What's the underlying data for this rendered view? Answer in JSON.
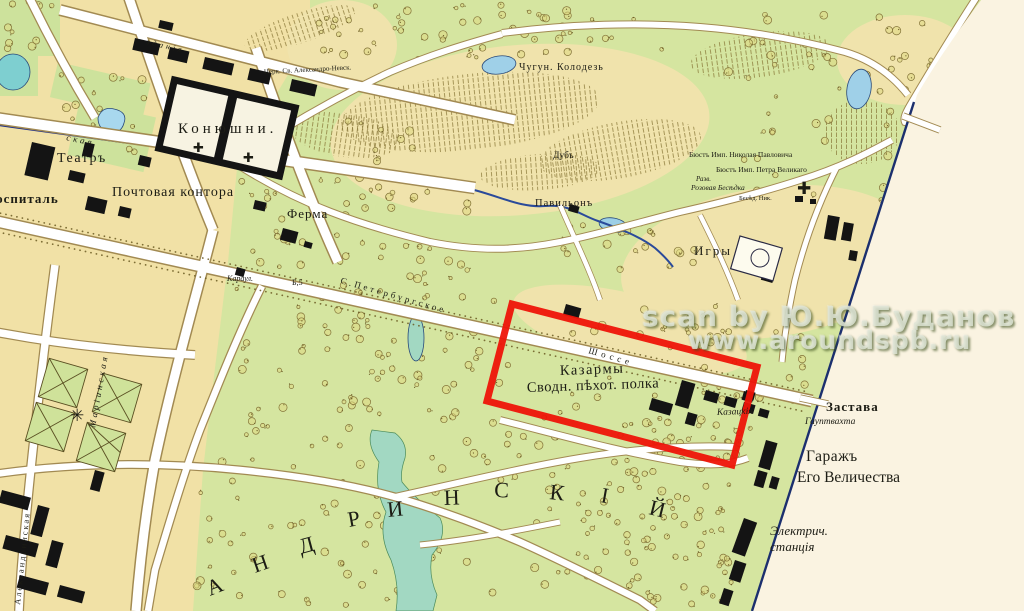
{
  "watermark": {
    "line1": "scan by Ю.Ю.Буданов",
    "line2": "www.aroundspb.ru"
  },
  "labels": {
    "hospital": "Госпиталь",
    "theater": "Театръ",
    "stables": "Конюшни.",
    "post_office": "Почтовая контора",
    "church_alexander": "Церк. Св. Александро-Невск.",
    "farm": "Ферма",
    "iron_well": "Чугун. Колодезь",
    "oak": "Дубъ",
    "pavilion": "Павильонъ",
    "games": "Игры",
    "bust_nicholas": "Бюстъ Имп. Николая Павловича",
    "bust_peter": "Бюстъ Имп. Петра Великаго",
    "ruins": "Разв.",
    "rose_arbor": "Розовая Бесѣдка",
    "arbor_nik": "Бесѣд. Ник.",
    "barracks_line1": "Казармы",
    "barracks_line2": "Сводн. пѣхот. полка",
    "cossack": "Казацкія",
    "outpost": "Застава",
    "guardhouse": "Гауптвахта",
    "garage_line1": "Гаражъ",
    "garage_line2": "Его Величества",
    "power_line1": "Электрич.",
    "power_line2": "станція",
    "road_petersburg": "С.Петербургское",
    "road_shosse": "Шоссе",
    "karaul": "Караул.",
    "verst_mark": "Б,5",
    "street_skaya": "ская",
    "street_zdaniya": "зданія",
    "street_maria": "Маріинская",
    "street_alexandrin": "Александринская"
  },
  "park_letters": [
    "А",
    "Н",
    "Д",
    "Р",
    "И",
    "Н",
    "С",
    "К",
    "І",
    "Й"
  ],
  "icons": {
    "church_cross": "✚",
    "monument_star": "✳"
  },
  "colors": {
    "park_green": "#d5e5a0",
    "town_tan": "#f1e1a6",
    "meadow": "#f0e3ac",
    "water": "#9fd0e8",
    "stream_teal": "#a2d8c2",
    "canal_blue": "#1d2f8c",
    "road_fill": "#ffffff",
    "building_black": "#141414",
    "highlight_red": "#ee1408",
    "margin_paper": "#faf3e1",
    "boundary_blue": "#1b2f6e"
  }
}
